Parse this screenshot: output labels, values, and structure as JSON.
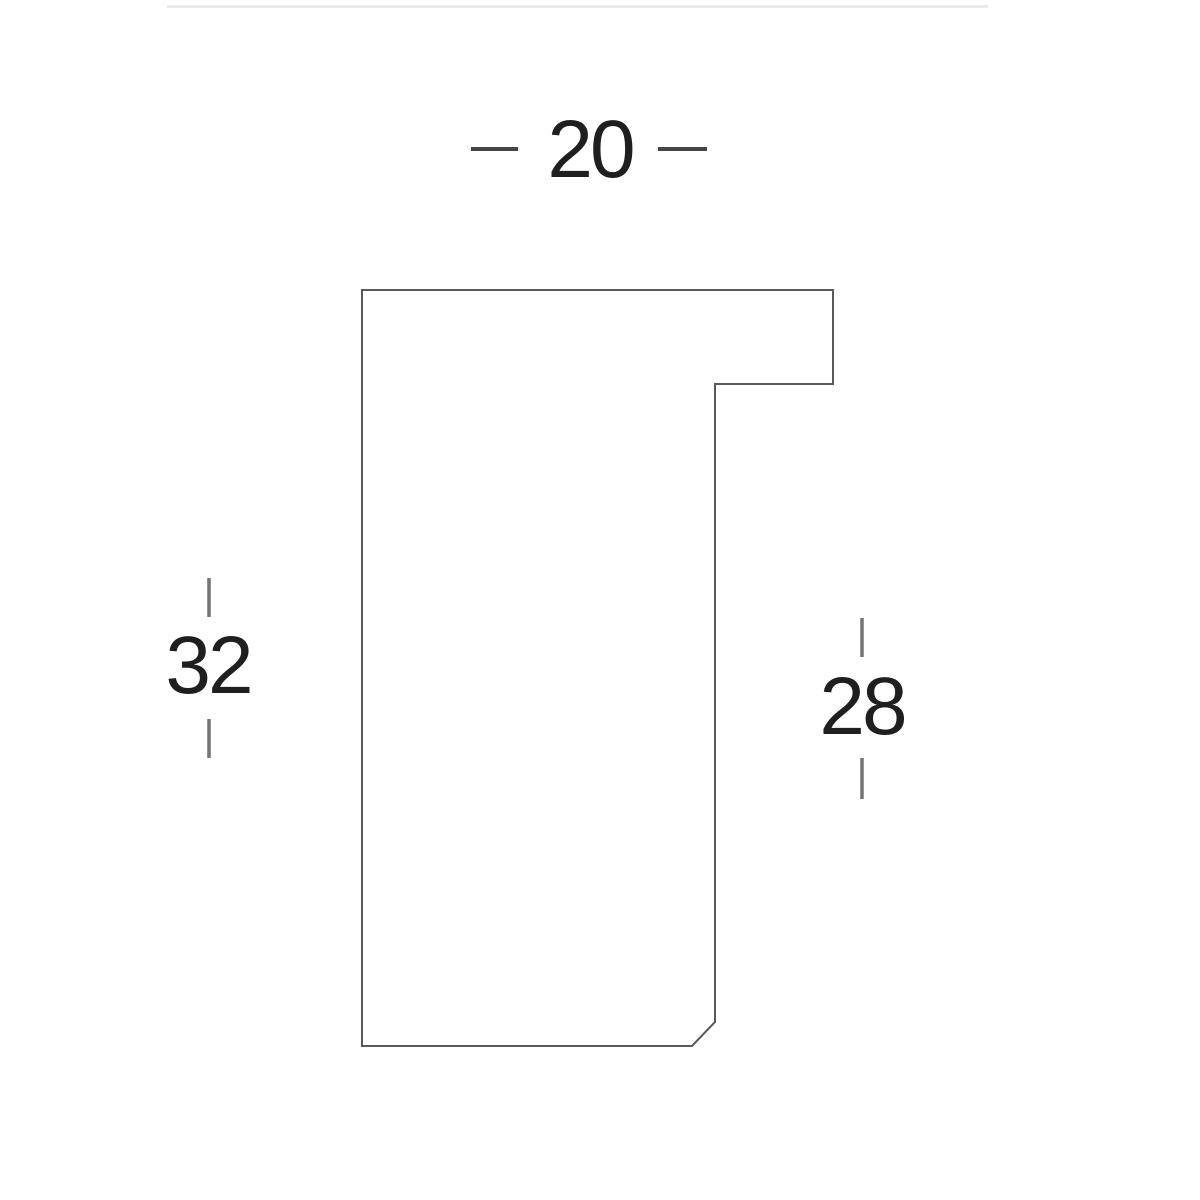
{
  "page": {
    "background_color": "#ffffff",
    "top_rule_color": "#eaeaea"
  },
  "diagram": {
    "outline_color": "#5a5a5a",
    "label_color": "#1f1f1f",
    "dash_color": "#454545",
    "tick_color": "#747474",
    "polygon_points": "362,290 833,290 833,384 715,384 715,1022 692,1046 362,1046",
    "dimensions": {
      "width_top": {
        "label": "20"
      },
      "height_left": {
        "label": "32"
      },
      "height_right": {
        "label": "28"
      }
    }
  }
}
